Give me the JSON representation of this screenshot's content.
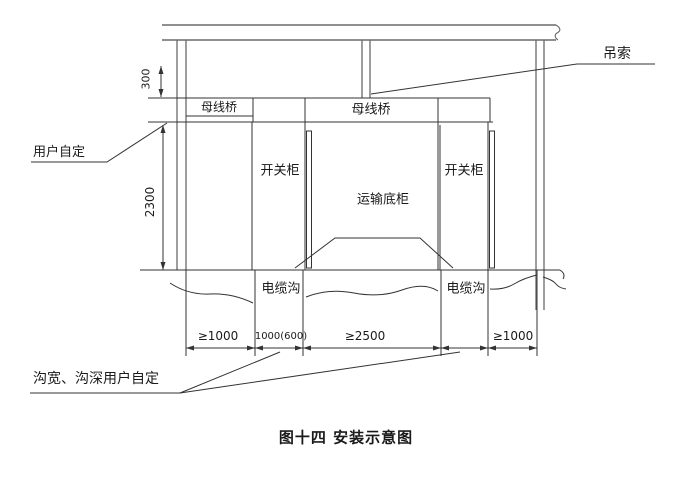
{
  "figure": {
    "caption": "图十四 安装示意图"
  },
  "labels": {
    "sling": "吊索",
    "busbar_bridge_left": "母线桥",
    "busbar_bridge_center": "母线桥",
    "user_defined": "用户自定",
    "switchgear_left": "开关柜",
    "switchgear_right": "开关柜",
    "transport_base": "运输底柜",
    "cable_trench_left": "电缆沟",
    "cable_trench_right": "电缆沟",
    "trench_note": "沟宽、沟深用户自定"
  },
  "dimensions": {
    "top_clearance": "300",
    "cabinet_height": "2300",
    "left_clearance": "≥1000",
    "left_trench_width": "1000(600)",
    "front_clearance": "≥2500",
    "right_clearance": "≥1000"
  },
  "colors": {
    "line_structural": "#6a6a6a",
    "line_detail": "#333333",
    "text": "#1a1a1a",
    "background": "#ffffff"
  }
}
